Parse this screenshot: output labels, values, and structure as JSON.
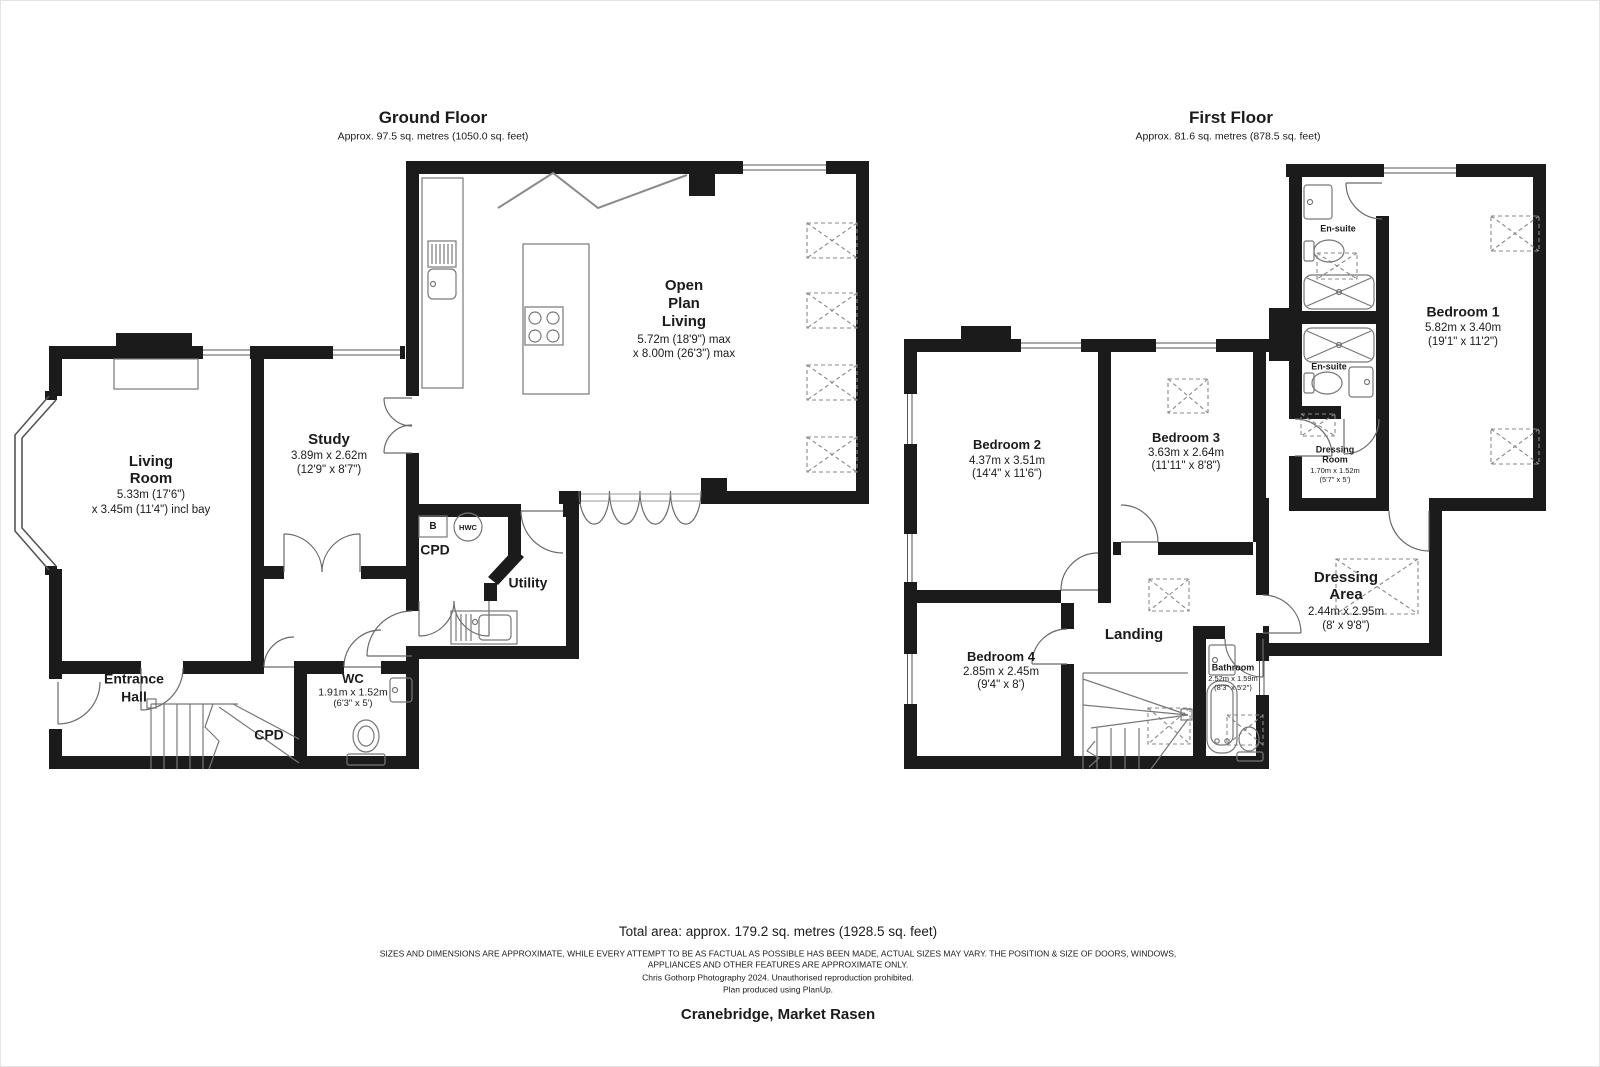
{
  "ground_floor": {
    "title": "Ground Floor",
    "subtitle": "Approx. 97.5 sq. metres (1050.0 sq. feet)",
    "rooms": {
      "living_room": {
        "name_line1": "Living",
        "name_line2": "Room",
        "dim1": "5.33m (17'6\")",
        "dim2": "x 3.45m (11'4\") incl bay"
      },
      "study": {
        "name": "Study",
        "dim1": "3.89m x 2.62m",
        "dim2": "(12'9\" x 8'7\")"
      },
      "open_plan_living": {
        "name_line1": "Open",
        "name_line2": "Plan",
        "name_line3": "Living",
        "dim1": "5.72m (18'9\") max",
        "dim2": "x 8.00m (26'3\") max"
      },
      "cpd": {
        "name": "CPD"
      },
      "utility": {
        "name": "Utility"
      },
      "wc": {
        "name": "WC",
        "dim1": "1.91m x 1.52m",
        "dim2": "(6'3\" x 5')"
      },
      "entrance_hall": {
        "name_line1": "Entrance",
        "name_line2": "Hall"
      },
      "cpd_understairs": {
        "name": "CPD"
      },
      "boiler_label": "B",
      "hwc_label": "HWC"
    }
  },
  "first_floor": {
    "title": "First Floor",
    "subtitle": "Approx. 81.6 sq. metres (878.5 sq. feet)",
    "rooms": {
      "bedroom_1": {
        "name": "Bedroom 1",
        "dim1": "5.82m x 3.40m",
        "dim2": "(19'1\" x 11'2\")"
      },
      "bedroom_2": {
        "name": "Bedroom 2",
        "dim1": "4.37m x 3.51m",
        "dim2": "(14'4\" x 11'6\")"
      },
      "bedroom_3": {
        "name": "Bedroom 3",
        "dim1": "3.63m x 2.64m",
        "dim2": "(11'11\" x 8'8\")"
      },
      "bedroom_4": {
        "name": "Bedroom 4",
        "dim1": "2.85m x 2.45m",
        "dim2": "(9'4\" x 8')"
      },
      "ensuite_top": {
        "name": "En-suite"
      },
      "ensuite_mid": {
        "name": "En-suite"
      },
      "dressing_room": {
        "name_line1": "Dressing",
        "name_line2": "Room",
        "dim1": "1.70m x 1.52m",
        "dim2": "(5'7\" x 5')"
      },
      "dressing_area": {
        "name_line1": "Dressing",
        "name_line2": "Area",
        "dim1": "2.44m x 2.95m",
        "dim2": "(8' x 9'8\")"
      },
      "landing": {
        "name": "Landing"
      },
      "bathroom": {
        "name": "Bathroom",
        "dim1": "2.52m x 1.59m",
        "dim2": "(8'3\" x 5'2\")"
      }
    }
  },
  "footer": {
    "total_area": "Total area: approx. 179.2 sq. metres (1928.5 sq. feet)",
    "disclaimer_line1": "SIZES AND DIMENSIONS ARE APPROXIMATE, WHILE EVERY ATTEMPT TO BE AS FACTUAL AS POSSIBLE HAS BEEN MADE, ACTUAL SIZES MAY VARY. THE POSITION & SIZE OF DOORS, WINDOWS,",
    "disclaimer_line2": "APPLIANCES AND OTHER FEATURES ARE APPROXIMATE ONLY.",
    "credit": "Chris Gothorp Photography 2024. Unauthorised reproduction prohibited.",
    "software": "Plan produced using PlanUp.",
    "address": "Cranebridge, Market Rasen"
  },
  "colors": {
    "wall": "#1b1b1b",
    "fixture": "#777777",
    "rooflight_dash": "#888888",
    "text": "#1b1b1b"
  }
}
